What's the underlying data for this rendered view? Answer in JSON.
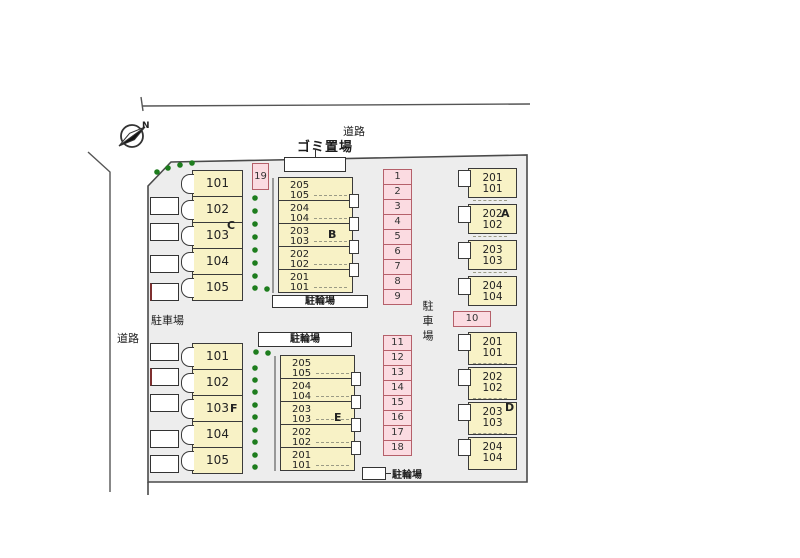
{
  "roads": {
    "top": "道路",
    "left": "道路"
  },
  "compass": {
    "north_label": "N"
  },
  "facilities": {
    "garbage_label": "ゴミ置場",
    "bike_label_b": "駐輪場",
    "bike_label_e": "駐輪場",
    "bike_label_bottom": "駐輪場"
  },
  "parking_labels": {
    "left": "駐車場",
    "right_vertical": "駐車場"
  },
  "parking": {
    "top_stalls": [
      "1",
      "2",
      "3",
      "4",
      "5",
      "6",
      "7",
      "8",
      "9"
    ],
    "stall_10": "10",
    "stall_19": "19",
    "bottom_stalls": [
      "11",
      "12",
      "13",
      "14",
      "15",
      "16",
      "17",
      "18"
    ]
  },
  "buildings": {
    "A": {
      "letter": "A",
      "rooms": [
        {
          "u": "201",
          "l": "101"
        },
        {
          "u": "202",
          "l": "102"
        },
        {
          "u": "203",
          "l": "103"
        },
        {
          "u": "204",
          "l": "104"
        }
      ]
    },
    "B": {
      "letter": "B",
      "rooms": [
        {
          "u": "205",
          "l": "105"
        },
        {
          "u": "204",
          "l": "104"
        },
        {
          "u": "203",
          "l": "103"
        },
        {
          "u": "202",
          "l": "102"
        },
        {
          "u": "201",
          "l": "101"
        }
      ]
    },
    "C": {
      "letter": "C",
      "rooms": [
        "101",
        "102",
        "103",
        "104",
        "105"
      ]
    },
    "D": {
      "letter": "D",
      "rooms": [
        {
          "u": "201",
          "l": "101"
        },
        {
          "u": "202",
          "l": "102"
        },
        {
          "u": "203",
          "l": "103"
        },
        {
          "u": "204",
          "l": "104"
        }
      ]
    },
    "E": {
      "letter": "E",
      "rooms": [
        {
          "u": "205",
          "l": "105"
        },
        {
          "u": "204",
          "l": "104"
        },
        {
          "u": "203",
          "l": "103"
        },
        {
          "u": "202",
          "l": "102"
        },
        {
          "u": "201",
          "l": "101"
        }
      ]
    },
    "F": {
      "letter": "F",
      "rooms": [
        "101",
        "102",
        "103",
        "104",
        "105"
      ]
    }
  },
  "colors": {
    "site_fill": "#ededed",
    "room_fill": "#f8f2c6",
    "stall_fill": "#fbdbe1",
    "stall_border": "#b5606a",
    "tree_green": "#1e7d1e"
  }
}
